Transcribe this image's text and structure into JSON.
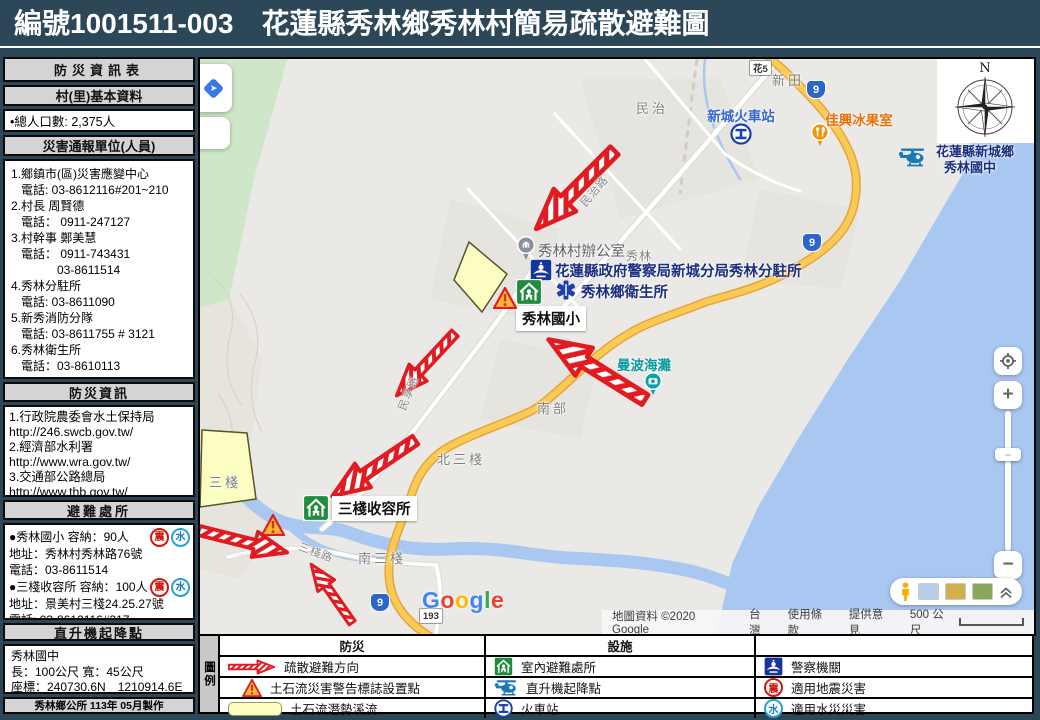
{
  "title": "編號1001511-003　花蓮縣秀林鄉秀林村簡易疏散避難圖",
  "badges": {
    "quake": "震",
    "flood": "水"
  },
  "sidebar": {
    "info_header": "防災資訊表",
    "basic_header": "村(里)基本資料",
    "population": "•總人口數:   2,375人",
    "report_header": "災害通報單位(人員)",
    "contacts": [
      "1.鄉鎮市(區)災害應變中心",
      "電話: 03-8612116#201~210",
      "2.村長 周賢德",
      "電話： 0911-247127",
      "3.村幹事 鄭美慧",
      "電話： 0911-743431",
      "03-8611514",
      "4.秀林分駐所",
      "電話: 03-8611090",
      "5.新秀消防分隊",
      "電話: 03-8611755  # 3121",
      "6.秀林衛生所",
      "電話：03-8610113"
    ],
    "info2_header": "防災資訊",
    "links": [
      "1.行政院農委會水土保持局",
      "http://246.swcb.gov.tw/",
      "2.經濟部水利署",
      "http://www.wra.gov.tw/",
      "3.交通部公路總局",
      "http://www.thb.gov.tw/"
    ],
    "shelter_header": "避難處所",
    "shelters": [
      {
        "name_line": "●秀林國小  容納：90人",
        "addr": "地址：秀林村秀林路76號",
        "tel": "電話：03-8611514"
      },
      {
        "name_line": "●三棧收容所  容納：100人",
        "addr": "地址：景美村三棧24.25.27號",
        "tel": "電話: 03-8612116#317"
      }
    ],
    "heliport_header": "直升機起降點",
    "heliport_name": "秀林國中",
    "heliport_size": "長：100公尺  寬：45公尺",
    "heliport_coord": "座標：240730.6N　1210914.6E",
    "footer": "秀林鄉公所 113年 05月製作"
  },
  "map": {
    "labels": {
      "xinTian": "新田",
      "minYou": "民有",
      "minZhi": "民治",
      "station": "新城火車站",
      "iceShop": "佳興冰果室",
      "juniorHigh1": "花蓮縣新城鄉",
      "juniorHigh2": "秀林國中",
      "villageOffice": "秀林村辦公室",
      "police": "花蓮縣政府警察局新城分局秀林分駐所",
      "health": "秀林鄉衛生所",
      "xiulin": "秀林",
      "elementary": "秀林國小",
      "beach": "曼波海灘",
      "nanbu": "南部",
      "beiSanzhan": "北三棧",
      "sanzhanShelter": "三棧收容所",
      "sanzhan": "三棧",
      "nanSanzhan": "南三棧",
      "minzhiRd": "民治路",
      "minxiangRd": "民享路",
      "sanzhanRd": "三棧路",
      "compassN": "N",
      "rt9": "9",
      "rt193": "193",
      "rtHua5": "花5"
    },
    "google": [
      "G",
      "o",
      "o",
      "g",
      "l",
      "e"
    ],
    "attribution": {
      "copy": "地圖資料 ©2020 Google",
      "region": "台灣",
      "terms": "使用條款",
      "feedback": "提供意見",
      "scale": "500 公尺"
    }
  },
  "legend": {
    "label": "圖例",
    "col1_header": "防災",
    "col2_header": "設施",
    "col3_header": "",
    "rows": [
      {
        "c1": "疏散避難方向",
        "c2": "室內避難處所",
        "c3": "警察機關"
      },
      {
        "c1": "土石流災害警告標誌設置點",
        "c2": "直升機起降點",
        "c3": "適用地震災害"
      },
      {
        "c1": "土石流潛勢溪流",
        "c2": "火車站",
        "c3": "適用水災災害"
      }
    ]
  }
}
